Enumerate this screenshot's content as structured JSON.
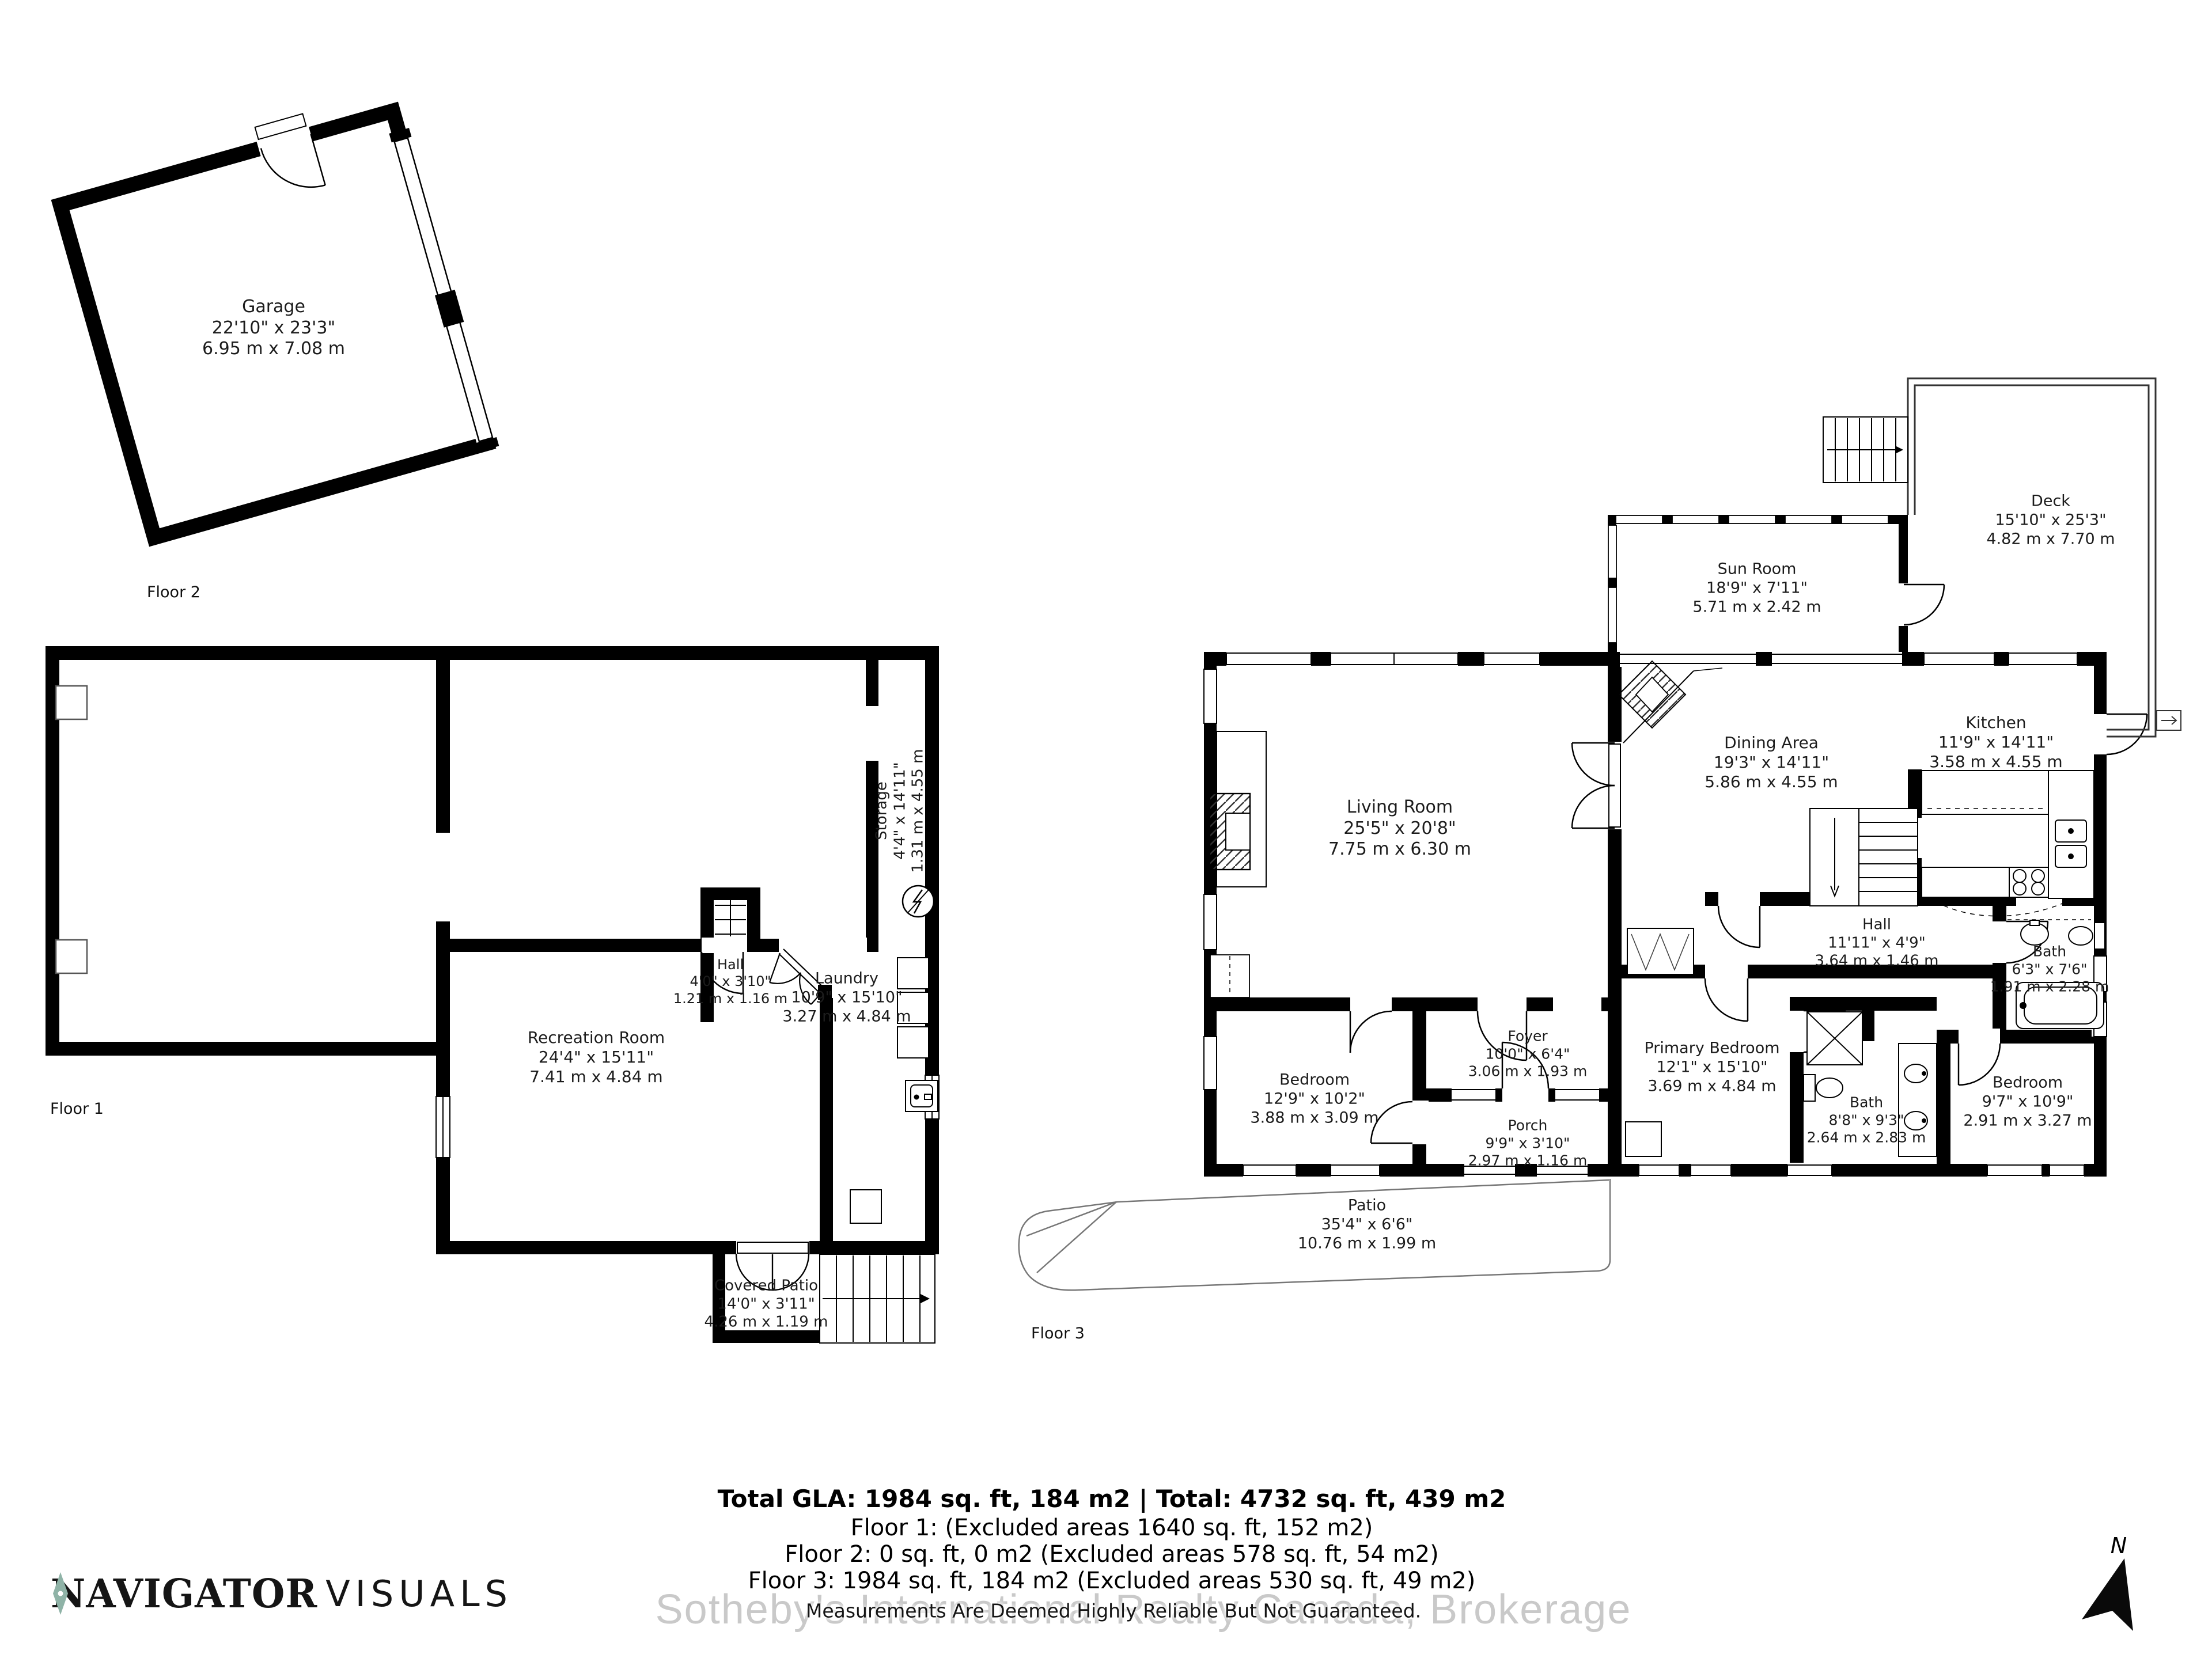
{
  "document": {
    "type": "real-estate floor plan"
  },
  "floors": [
    {
      "label": "Floor 1"
    },
    {
      "label": "Floor 2"
    },
    {
      "label": "Floor 3"
    }
  ],
  "rooms": [
    {
      "name": "Garage",
      "imperial": "22'10\" x 23'3\"",
      "metric": "6.95 m x 7.08 m"
    },
    {
      "name": "Storage",
      "imperial": "4'4\" x 14'11\"",
      "metric": "1.31 m x 4.55 m"
    },
    {
      "name": "Hall",
      "imperial": "4'0\" x 3'10\"",
      "metric": "1.21 m x 1.16 m"
    },
    {
      "name": "Laundry",
      "imperial": "10'9\" x 15'10\"",
      "metric": "3.27 m x 4.84 m"
    },
    {
      "name": "Recreation Room",
      "imperial": "24'4\" x 15'11\"",
      "metric": "7.41 m x 4.84 m"
    },
    {
      "name": "Covered Patio",
      "imperial": "14'0\" x 3'11\"",
      "metric": "4.26 m x 1.19 m"
    },
    {
      "name": "Living Room",
      "imperial": "25'5\" x 20'8\"",
      "metric": "7.75 m x 6.30 m"
    },
    {
      "name": "Dining Area",
      "imperial": "19'3\" x 14'11\"",
      "metric": "5.86 m x 4.55 m"
    },
    {
      "name": "Kitchen",
      "imperial": "11'9\" x 14'11\"",
      "metric": "3.58 m x 4.55 m"
    },
    {
      "name": "Sun Room",
      "imperial": "18'9\" x 7'11\"",
      "metric": "5.71 m x 2.42 m"
    },
    {
      "name": "Deck",
      "imperial": "15'10\" x 25'3\"",
      "metric": "4.82 m x 7.70 m"
    },
    {
      "name": "Foyer",
      "imperial": "10'0\" x 6'4\"",
      "metric": "3.06 m x 1.93 m"
    },
    {
      "name": "Porch",
      "imperial": "9'9\" x 3'10\"",
      "metric": "2.97 m x 1.16 m"
    },
    {
      "name": "Bedroom",
      "imperial": "12'9\" x 10'2\"",
      "metric": "3.88 m x 3.09 m"
    },
    {
      "name": "Primary Bedroom",
      "imperial": "12'1\" x 15'10\"",
      "metric": "3.69 m x 4.84 m"
    },
    {
      "name": "Hall",
      "imperial": "11'11\" x 4'9\"",
      "metric": "3.64 m x 1.46 m"
    },
    {
      "name": "Bath",
      "imperial": "6'3\" x 7'6\"",
      "metric": "1.91 m x 2.28 m"
    },
    {
      "name": "Bath",
      "imperial": "8'8\" x 9'3\"",
      "metric": "2.64 m x 2.83 m"
    },
    {
      "name": "Bedroom",
      "imperial": "9'7\" x 10'9\"",
      "metric": "2.91 m x 3.27 m"
    },
    {
      "name": "Patio",
      "imperial": "35'4\" x 6'6\"",
      "metric": "10.76 m x 1.99 m"
    }
  ],
  "summary": {
    "line1": "Total GLA: 1984 sq. ft, 184 m2 | Total: 4732 sq. ft, 439 m2",
    "line2": "Floor 1: (Excluded areas 1640 sq. ft, 152 m2)",
    "line3": "Floor 2: 0 sq. ft, 0 m2 (Excluded areas 578 sq. ft, 54 m2)",
    "line4": "Floor 3: 1984 sq. ft, 184 m2 (Excluded areas 530 sq. ft, 49 m2)"
  },
  "disclaimer": "Measurements Are Deemed Highly Reliable But Not Guaranteed.",
  "watermark": "Sotheby's International Realty Canada,  Brokerage",
  "logo": {
    "word1": "NAVIGATOR",
    "word2": "VISUALS",
    "icon": "compass-needle-icon",
    "accent_color": "#8fb3a7"
  },
  "north": {
    "label": "N",
    "icon": "north-arrow-icon"
  }
}
